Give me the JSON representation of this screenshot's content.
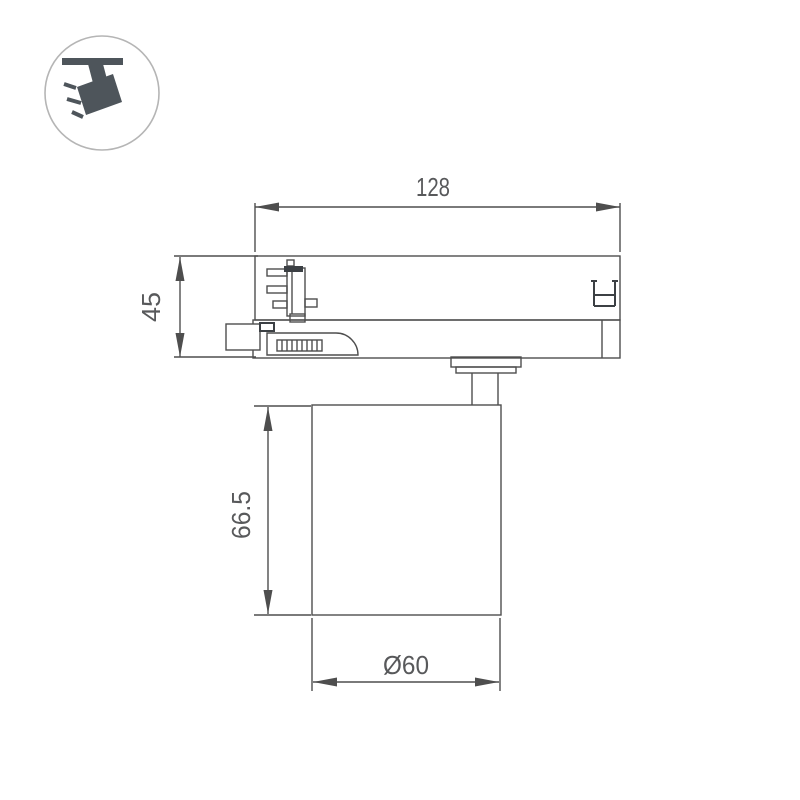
{
  "drawing_title": "track-spotlight-dimension-drawing",
  "legend_icon": {
    "name": "track-spotlight-icon"
  },
  "dimensions": {
    "track_width": {
      "value": "128"
    },
    "adapter_height": {
      "value": "45"
    },
    "body_height": {
      "value": "66.5"
    },
    "body_diameter": {
      "value": "Ø60"
    }
  },
  "colors": {
    "line": "#4e4e4e",
    "dark": "#3c4044",
    "text": "#58595b",
    "icon": "#4e555b",
    "circle": "#b5b5b5",
    "bg": "#ffffff"
  }
}
